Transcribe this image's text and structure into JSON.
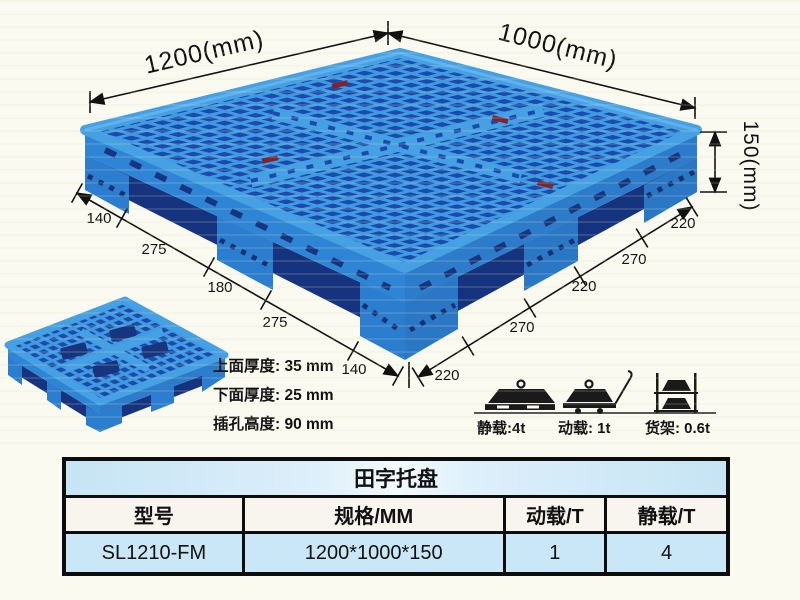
{
  "colors": {
    "pallet_blue": "#2E86D8",
    "pallet_light": "#46A0E4",
    "pallet_hole_dark": "#1B49AE",
    "pallet_under_dark": "#16337F",
    "dim_line": "#111111",
    "table_band_blue": "#C9E7F6",
    "table_paper": "#F8F5EE"
  },
  "illustration": {
    "length_label": "1200(mm)",
    "width_label": "1000(mm)",
    "height_label": "150(mm)",
    "left_edge_dims": [
      "140",
      "275",
      "180",
      "275",
      "140"
    ],
    "right_edge_dims": [
      "220",
      "270",
      "220",
      "270",
      "220"
    ],
    "thickness_notes": [
      "上面厚度: 35 mm",
      "下面厚度: 25 mm",
      "插孔高度: 90 mm"
    ],
    "load_ratings": [
      {
        "icon": "static-load-icon",
        "label": "静载:4t"
      },
      {
        "icon": "dynamic-load-icon",
        "label": "动载: 1t"
      },
      {
        "icon": "rack-load-icon",
        "label": "货架: 0.6t"
      }
    ]
  },
  "table": {
    "title": "田字托盘",
    "headers": [
      "型号",
      "规格/MM",
      "动载/T",
      "静载/T"
    ],
    "rows": [
      [
        "SL1210-FM",
        "1200*1000*150",
        "1",
        "4"
      ]
    ]
  }
}
